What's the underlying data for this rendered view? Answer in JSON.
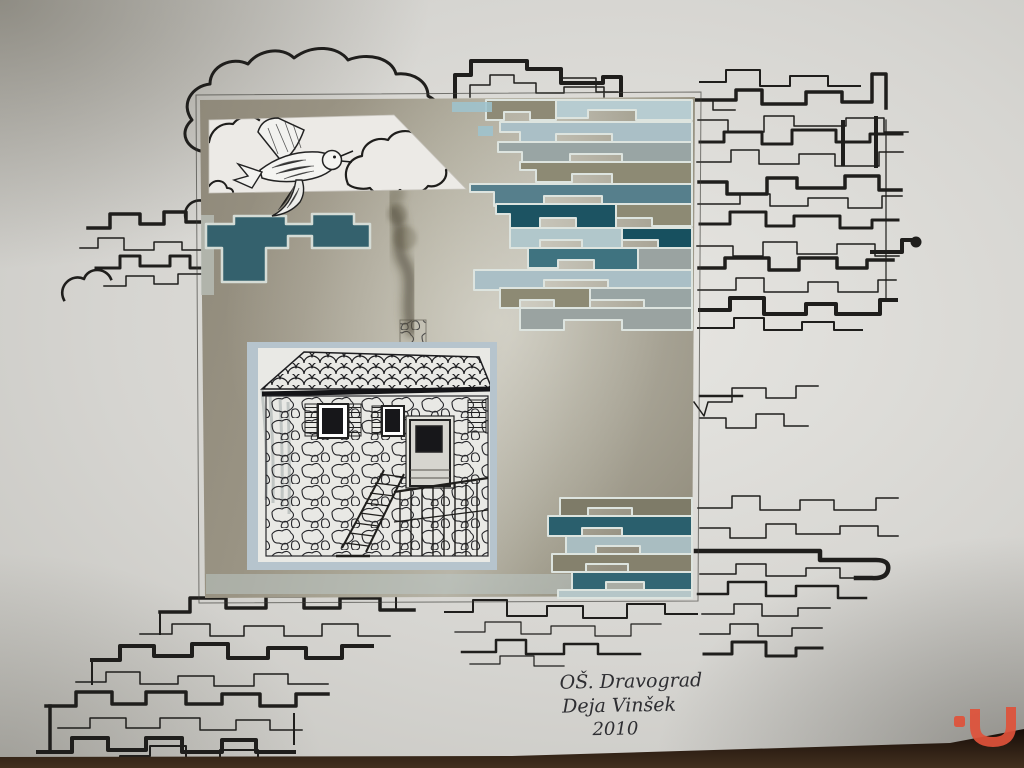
{
  "artwork": {
    "signature": {
      "line1": "OŠ. Dravograd",
      "line2": "Deja Vinšek",
      "line3": "2010"
    },
    "palette": {
      "wall": "#d4d3cf",
      "board_olive": "#9d9786",
      "teal_dark": "#1c5362",
      "teal": "#3f7380",
      "teal_mid": "#567f8c",
      "blue_light": "#adc3c9",
      "gray_band": "#99a5a4",
      "olive_band": "#8d8a74",
      "ink": "#1f1e1c",
      "house_mat_blue": "#b6c4cd",
      "paper_white": "#e9e9e5",
      "watermark_orange": "#e0523a",
      "table_brown": "#2a1a10"
    }
  }
}
